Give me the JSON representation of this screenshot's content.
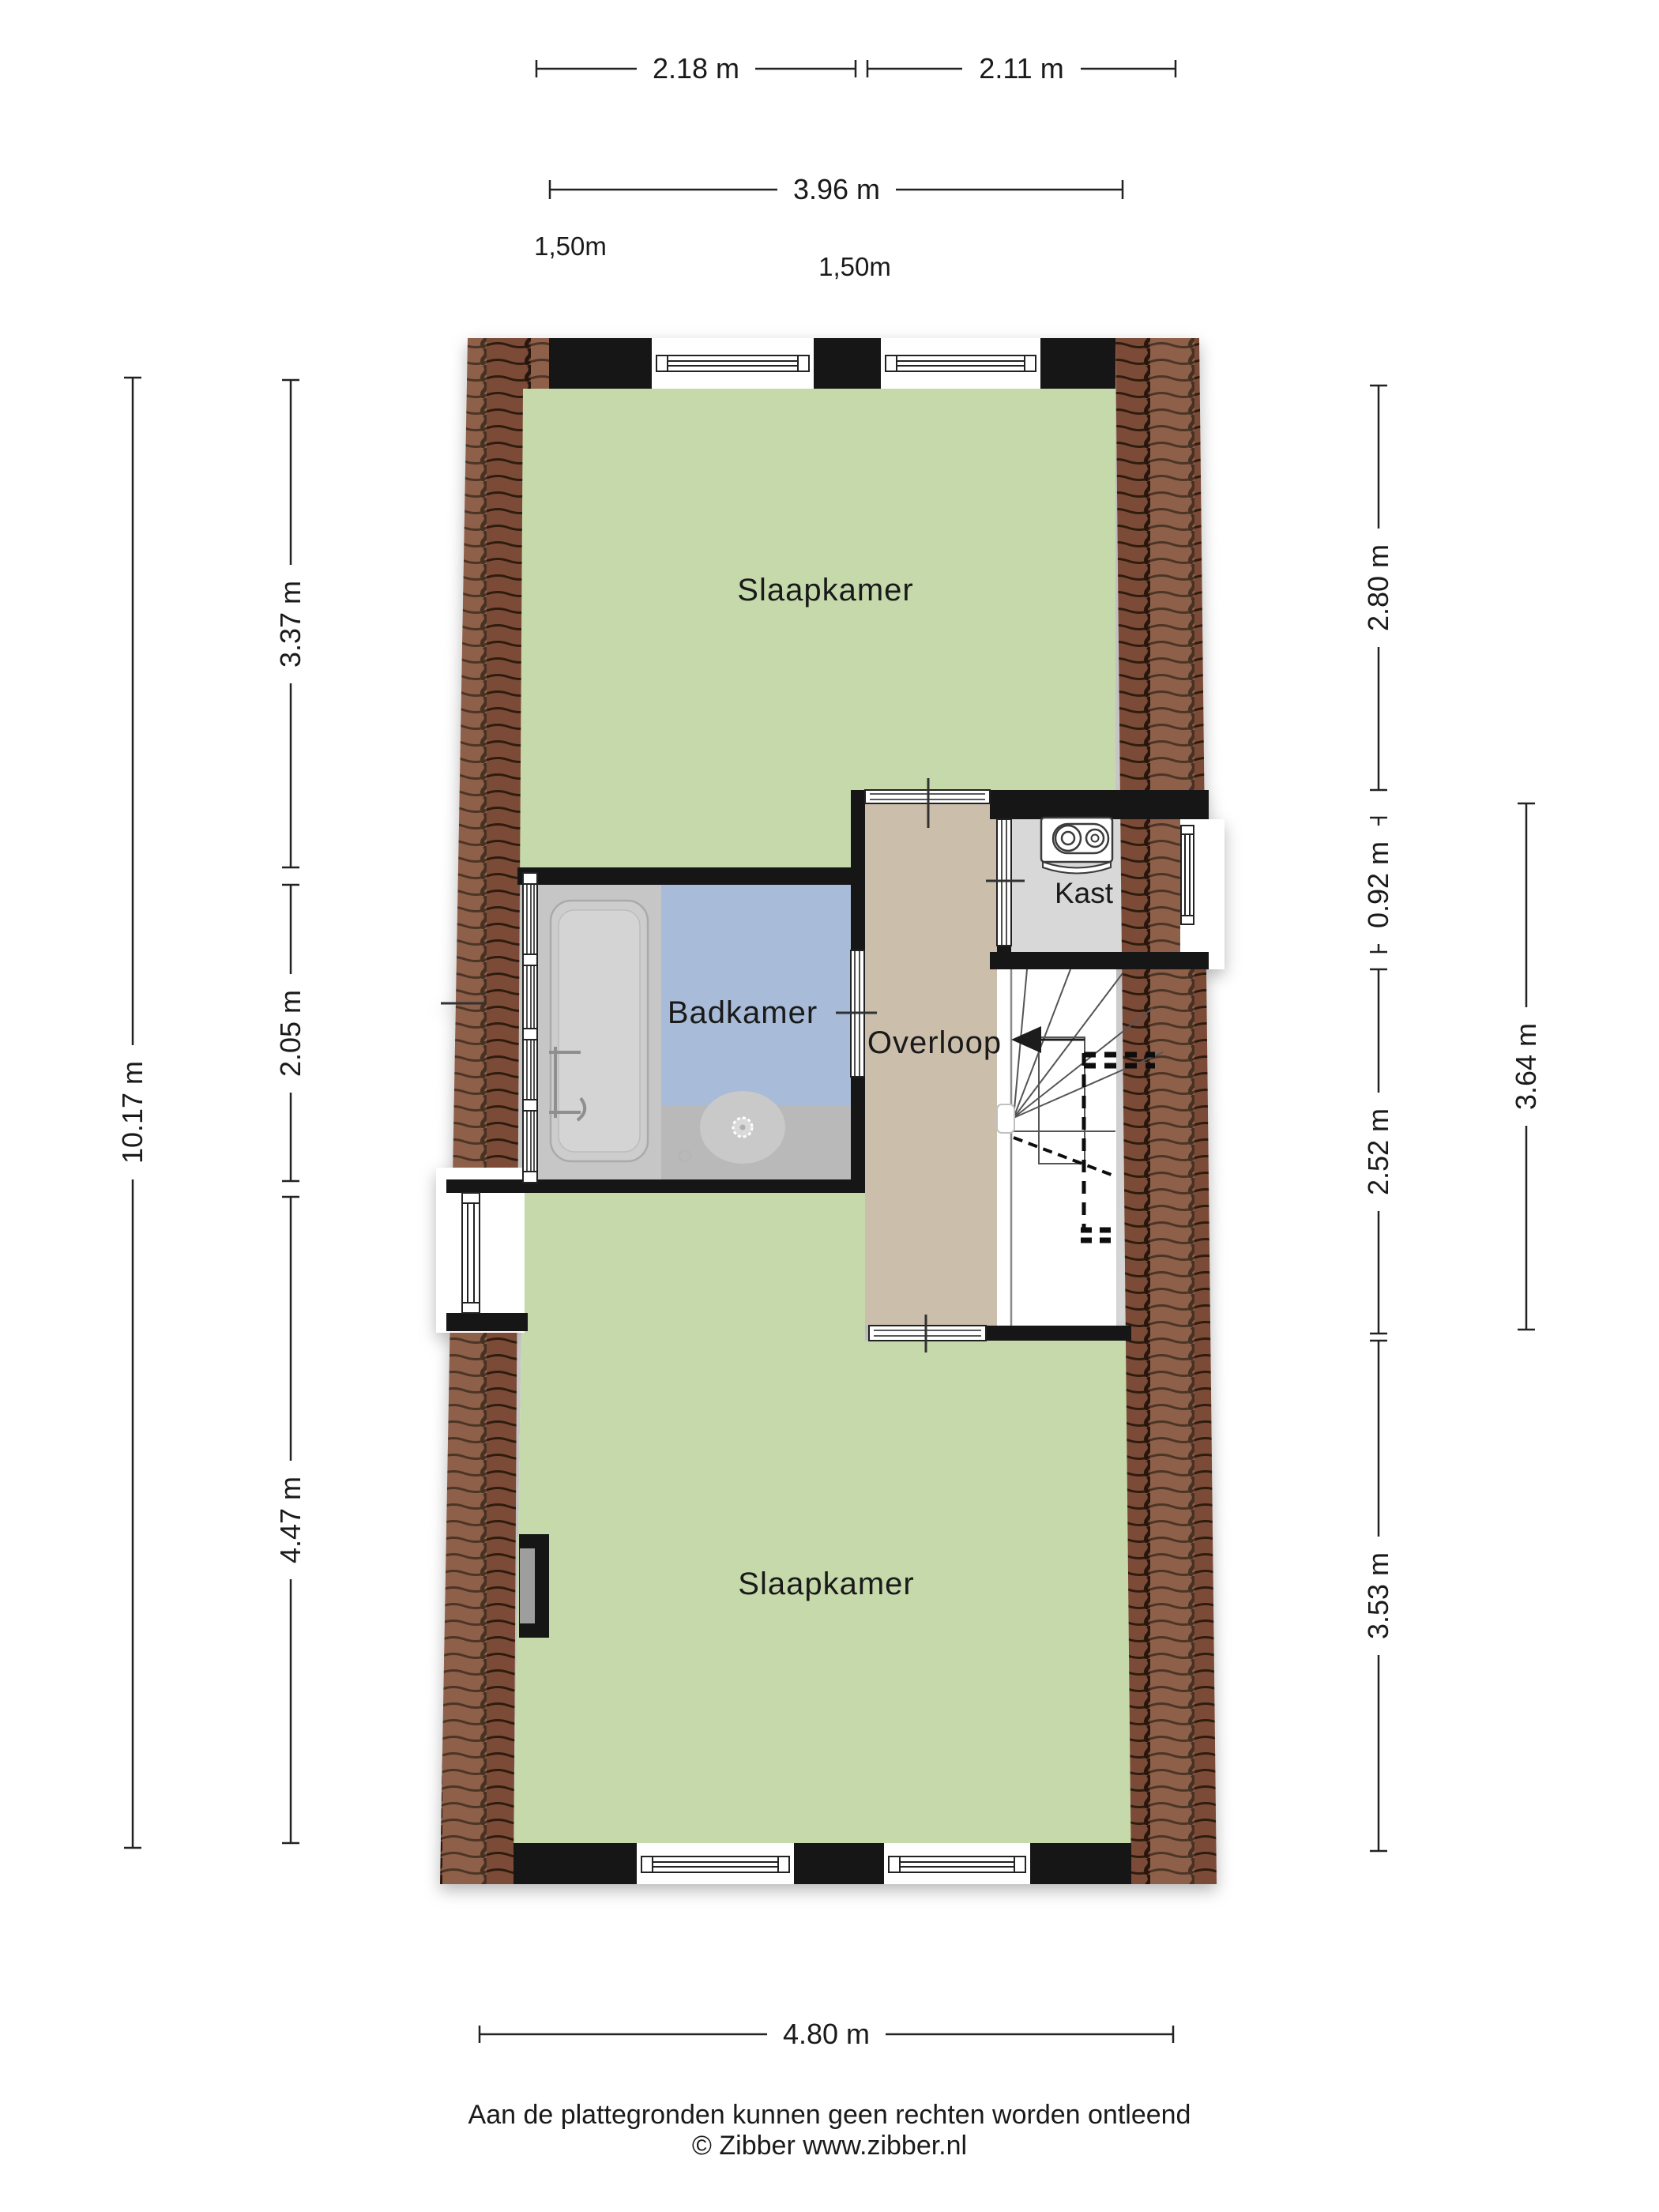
{
  "rooms": [
    {
      "id": "slaapkamer-top",
      "label": "Slaapkamer"
    },
    {
      "id": "badkamer",
      "label": "Badkamer"
    },
    {
      "id": "overloop",
      "label": "Overloop"
    },
    {
      "id": "kast",
      "label": "Kast"
    },
    {
      "id": "slaapkamer-bottom",
      "label": "Slaapkamer"
    }
  ],
  "dimensions": {
    "top_row": [
      {
        "label": "2.18 m"
      },
      {
        "label": "2.11 m"
      }
    ],
    "top_total": {
      "label": "3.96 m"
    },
    "height_markers": [
      {
        "label": "1,50m"
      },
      {
        "label": "1,50m"
      }
    ],
    "left_outer": {
      "label": "10.17 m"
    },
    "left_inner": [
      {
        "label": "3.37 m"
      },
      {
        "label": "2.05 m"
      },
      {
        "label": "4.47 m"
      }
    ],
    "right_inner": [
      {
        "label": "2.80 m"
      },
      {
        "label": "0.92 m"
      },
      {
        "label": "2.52 m"
      },
      {
        "label": "3.53 m"
      }
    ],
    "right_outer": {
      "label": "3.64 m"
    },
    "bottom": {
      "label": "4.80 m"
    }
  },
  "footer": {
    "disclaimer": "Aan de plattegronden kunnen geen rechten worden ontleend",
    "copyright": "© Zibber www.zibber.nl"
  },
  "icons": [
    {
      "name": "bathtub-icon"
    },
    {
      "name": "shower-drain-icon"
    },
    {
      "name": "ventilation-unit-icon"
    },
    {
      "name": "stairs-direction-arrow"
    }
  ],
  "colors": {
    "text": "#1a1a1a",
    "green": "#c5d9ab",
    "blue": "#a8bbd8",
    "tan": "#cbbeab",
    "kast_gray": "#d8d8d8",
    "fixture_gray": "#c6c6c6",
    "tub_gray": "#cdcdcd",
    "shower_gray": "#b9b9b9",
    "wall": "#141414",
    "tile_base": "#7c4c39",
    "tile_line": "#2f1a11",
    "dim_line": "#222222"
  }
}
